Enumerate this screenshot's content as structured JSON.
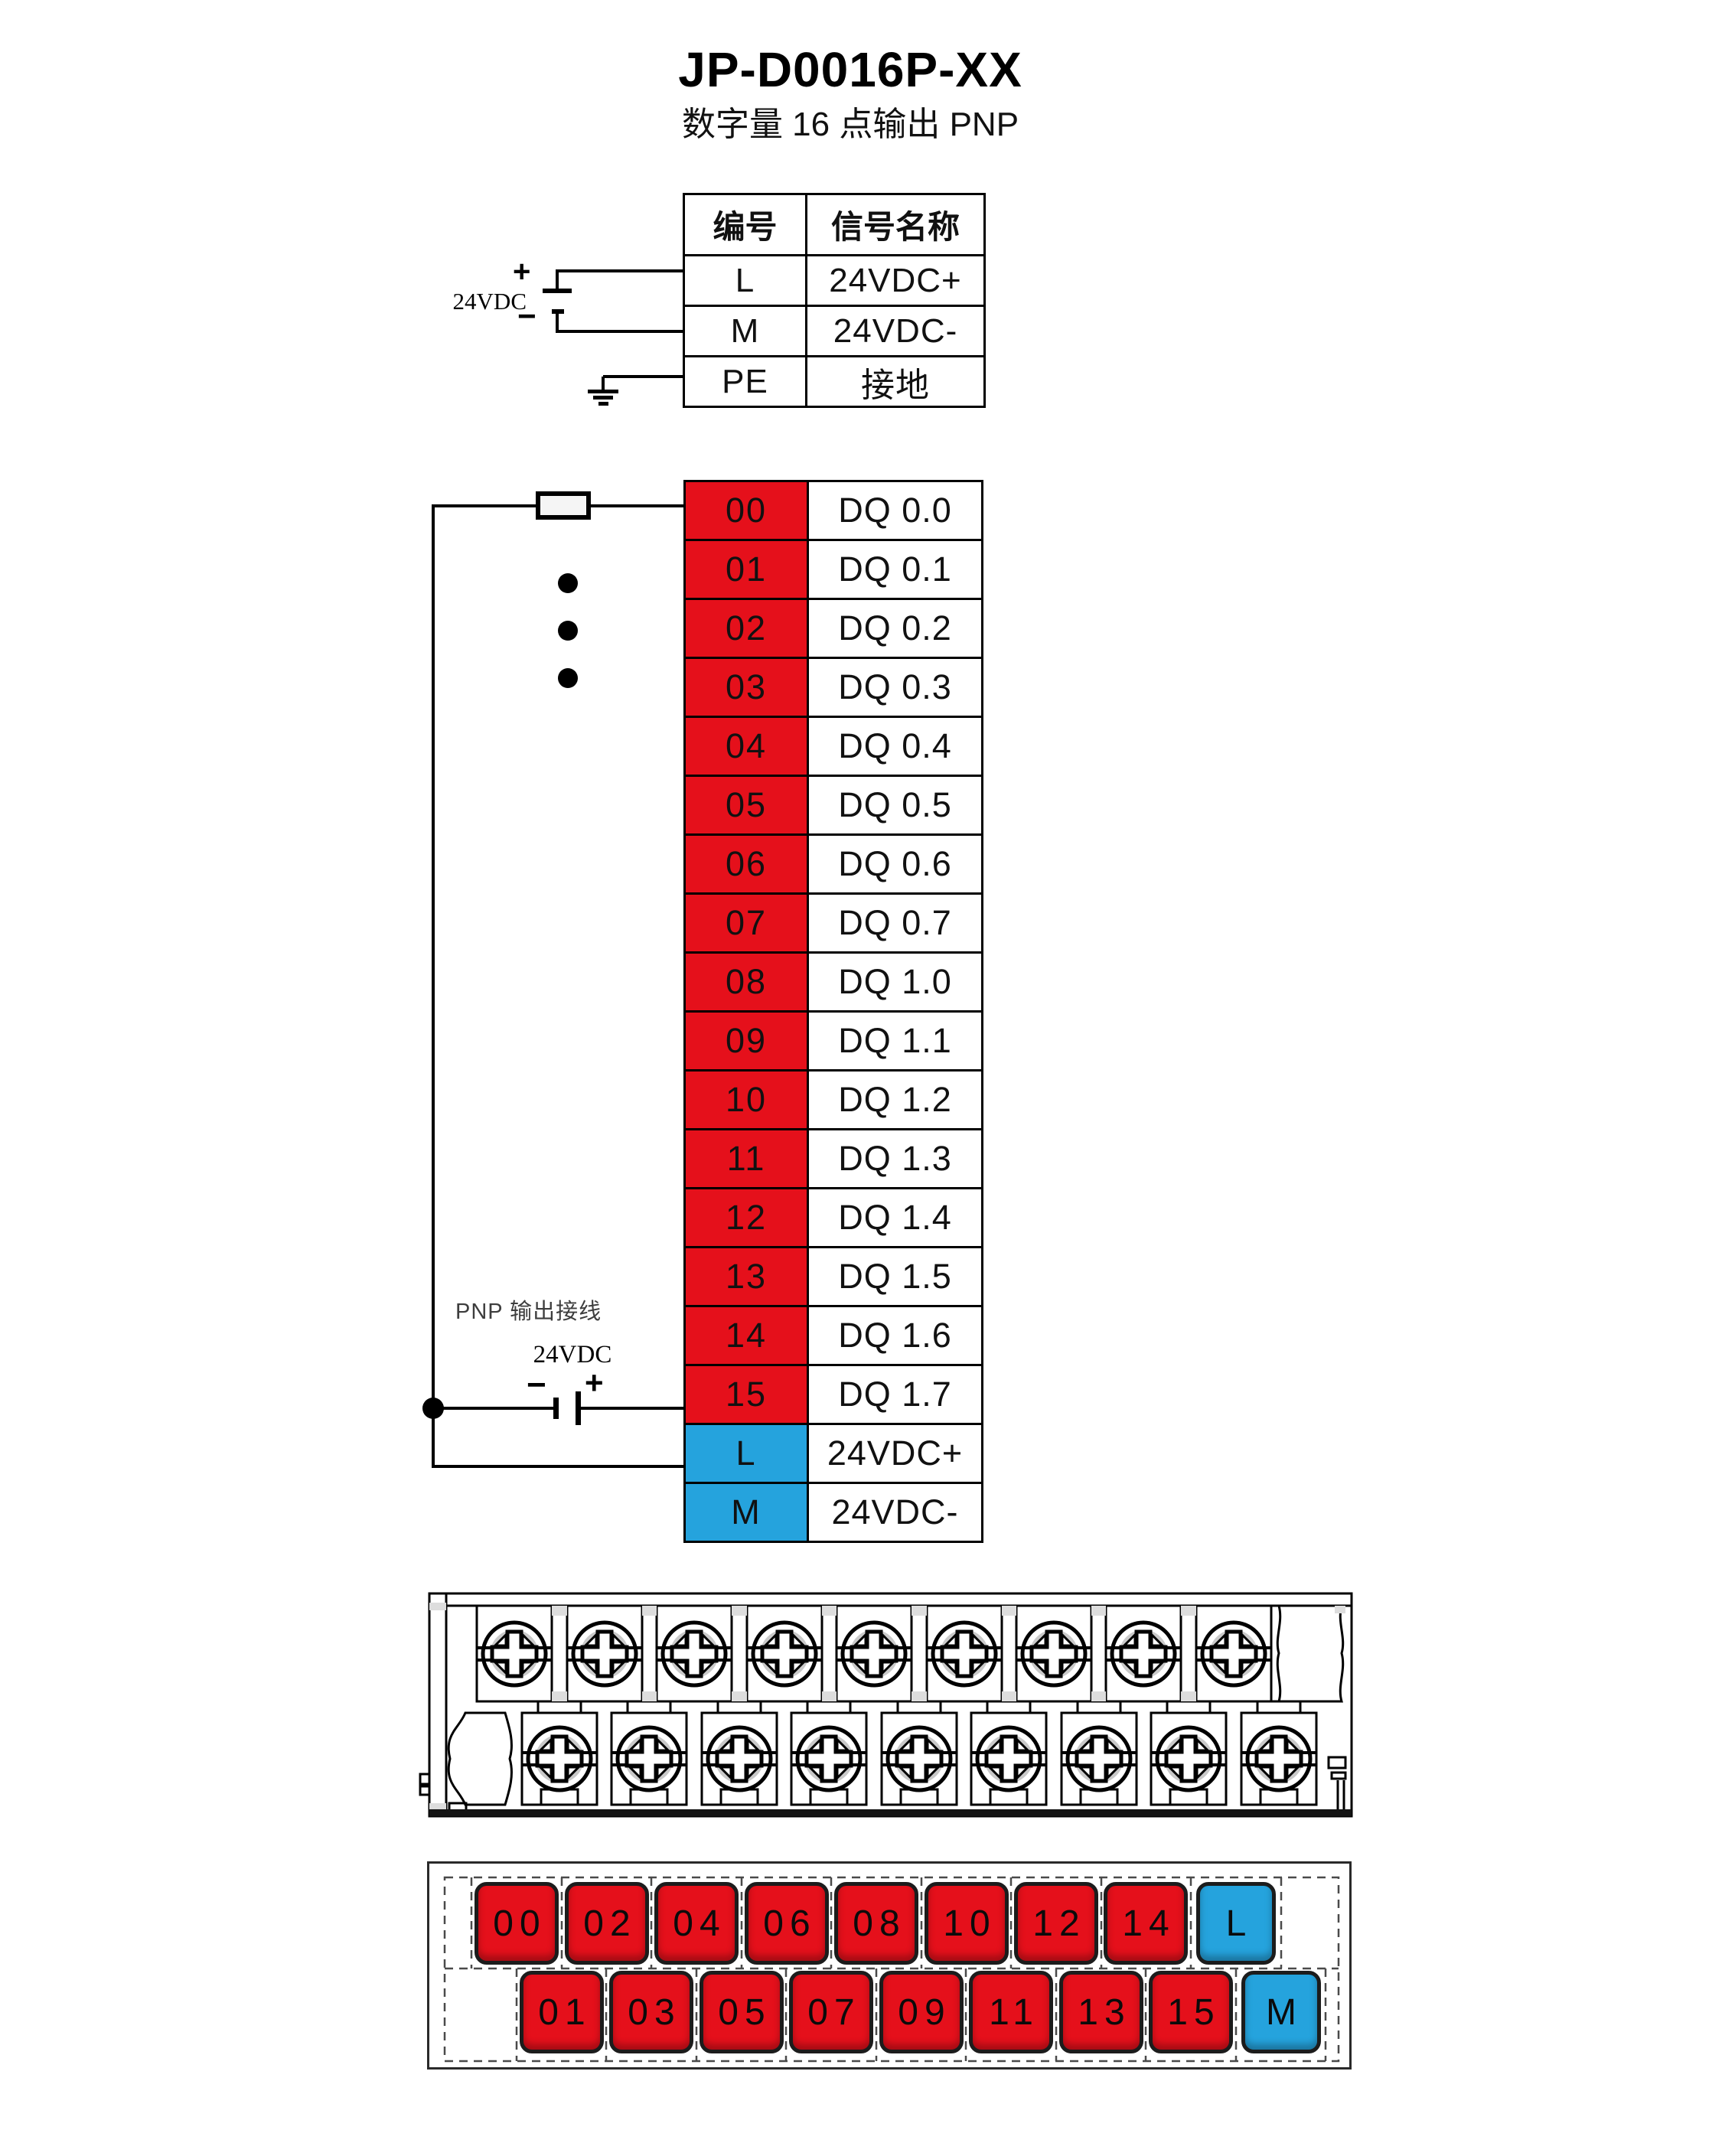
{
  "title": "JP-D0016P-XX",
  "subtitle": "数字量 16 点输出  PNP",
  "colors": {
    "terminal_red": "#e5101b",
    "terminal_blue": "#25a3dd",
    "wire": "#000000"
  },
  "power_table": {
    "col_headers": [
      "编号",
      "信号名称"
    ],
    "rows": [
      {
        "pin": "L",
        "signal": "24VDC+"
      },
      {
        "pin": "M",
        "signal": "24VDC-"
      },
      {
        "pin": "PE",
        "signal": "接地"
      }
    ]
  },
  "top_psu": {
    "label": "24VDC",
    "plus": "+",
    "minus": "−"
  },
  "io_table": {
    "rows": [
      {
        "pin": "00",
        "signal": "DQ 0.0",
        "color": "red"
      },
      {
        "pin": "01",
        "signal": "DQ 0.1",
        "color": "red"
      },
      {
        "pin": "02",
        "signal": "DQ 0.2",
        "color": "red"
      },
      {
        "pin": "03",
        "signal": "DQ 0.3",
        "color": "red"
      },
      {
        "pin": "04",
        "signal": "DQ 0.4",
        "color": "red"
      },
      {
        "pin": "05",
        "signal": "DQ 0.5",
        "color": "red"
      },
      {
        "pin": "06",
        "signal": "DQ 0.6",
        "color": "red"
      },
      {
        "pin": "07",
        "signal": "DQ 0.7",
        "color": "red"
      },
      {
        "pin": "08",
        "signal": "DQ 1.0",
        "color": "red"
      },
      {
        "pin": "09",
        "signal": "DQ 1.1",
        "color": "red"
      },
      {
        "pin": "10",
        "signal": "DQ 1.2",
        "color": "red"
      },
      {
        "pin": "11",
        "signal": "DQ 1.3",
        "color": "red"
      },
      {
        "pin": "12",
        "signal": "DQ 1.4",
        "color": "red"
      },
      {
        "pin": "13",
        "signal": "DQ 1.5",
        "color": "red"
      },
      {
        "pin": "14",
        "signal": "DQ 1.6",
        "color": "red"
      },
      {
        "pin": "15",
        "signal": "DQ 1.7",
        "color": "red"
      },
      {
        "pin": "L",
        "signal": "24VDC+",
        "color": "blue"
      },
      {
        "pin": "M",
        "signal": "24VDC-",
        "color": "blue"
      }
    ]
  },
  "wiring_note": "PNP 输出接线",
  "bottom_psu": {
    "label": "24VDC",
    "plus": "+",
    "minus": "−"
  },
  "terminal_strip": {
    "top_screws": 9,
    "bottom_screws": 9
  },
  "terminal_layout": {
    "top_row": [
      "00",
      "02",
      "04",
      "06",
      "08",
      "10",
      "12",
      "14",
      "L"
    ],
    "bottom_row": [
      "01",
      "03",
      "05",
      "07",
      "09",
      "11",
      "13",
      "15",
      "M"
    ]
  }
}
